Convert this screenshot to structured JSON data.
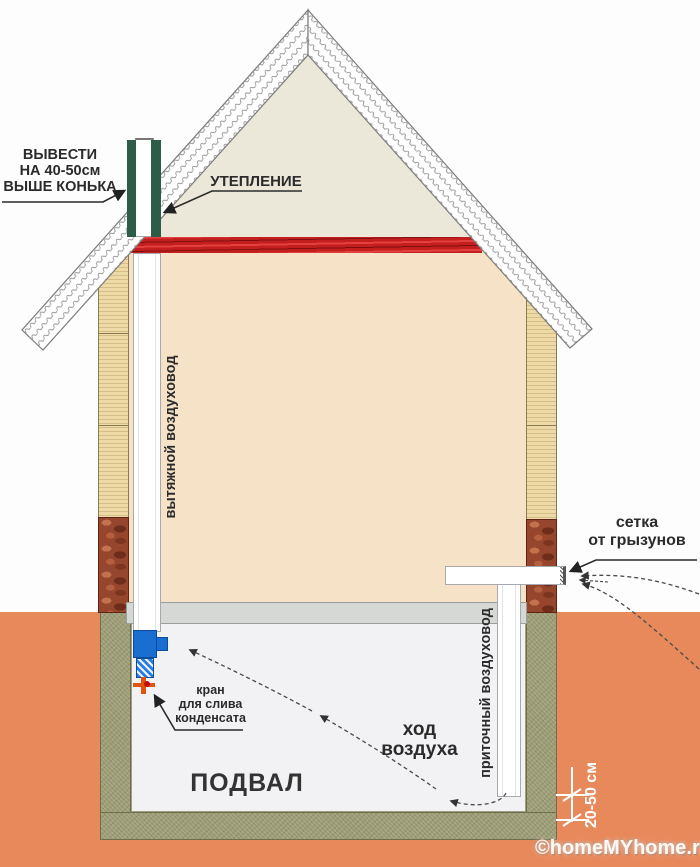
{
  "labels": {
    "ridge_outlet": {
      "line1": "ВЫВЕСТИ",
      "line2": "НА 40-50см",
      "line3": "ВЫШЕ КОНЬКА"
    },
    "insulation": "УТЕПЛЕНИЕ",
    "exhaust_duct": "вытяжной воздуховод",
    "supply_duct": "приточный воздуховод",
    "rodent_mesh": {
      "line1": "сетка",
      "line2": "от грызунов"
    },
    "condensate_drain": {
      "line1": "кран",
      "line2": "для слива",
      "line3": "конденсата"
    },
    "air_flow": {
      "line1": "ход",
      "line2": "воздуха"
    },
    "basement": "ПОДВАЛ",
    "floor_clearance": "20-50 см"
  },
  "watermark": "©homeMYhome.ru",
  "colors": {
    "soil": "#e8895b",
    "wall": "#eedaa6",
    "brick": "#96462c",
    "foundation": "#9c9c75",
    "slab": "#d5d8d4",
    "ceiling_insulation": "#c41f1f",
    "pipe_insulation": "#2d5c49",
    "fan": "#1a6ed2",
    "valve": "#e2540e",
    "interior": "#f6e3c7",
    "attic": "#ebe8da",
    "basement": "#f2f2f4",
    "text": "#2b2b2b"
  }
}
